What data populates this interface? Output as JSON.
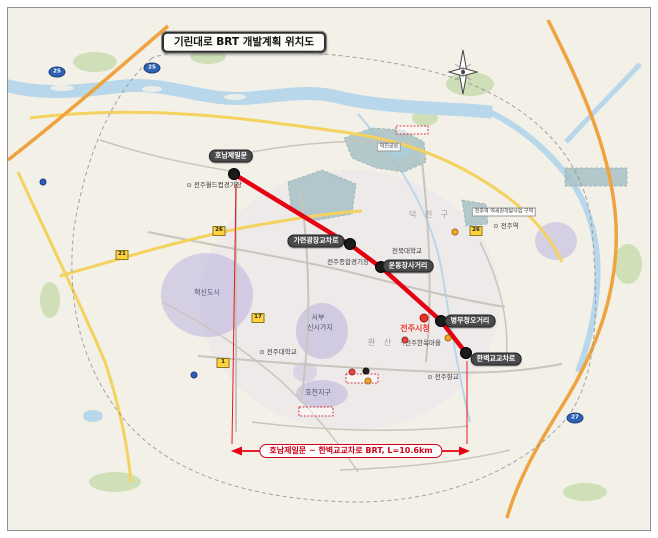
{
  "title": "기린대로 BRT 개발계획 위치도",
  "route": {
    "color": "#e60012",
    "summary_label": "호남제일문 ~ 한벽교교차로 BRT,  L=10.6km",
    "stops": [
      {
        "label": "호남제일문",
        "dot": {
          "x": 234,
          "y": 174
        },
        "pill": {
          "x": 231,
          "y": 156
        }
      },
      {
        "label": "가련광장교차로",
        "dot": {
          "x": 350,
          "y": 244
        },
        "pill": {
          "x": 316,
          "y": 241
        }
      },
      {
        "label": "운동장사거리",
        "dot": {
          "x": 381,
          "y": 267
        },
        "pill": {
          "x": 408,
          "y": 266
        }
      },
      {
        "label": "병무청오거리",
        "dot": {
          "x": 441,
          "y": 321
        },
        "pill": {
          "x": 470,
          "y": 321
        }
      },
      {
        "label": "한벽교교차로",
        "dot": {
          "x": 466,
          "y": 353
        },
        "pill": {
          "x": 496,
          "y": 359
        }
      }
    ]
  },
  "city_hall": {
    "label": "전주시청",
    "x": 415,
    "y": 329,
    "dot": {
      "x": 424,
      "y": 318
    }
  },
  "districts": [
    {
      "label": "덕 진 구",
      "x": 430,
      "y": 215
    },
    {
      "label": "완 산 구",
      "x": 389,
      "y": 343
    }
  ],
  "landmarks": [
    {
      "label": "전주월드컵경기장",
      "x": 214,
      "y": 185,
      "style": "tiny",
      "icon": true
    },
    {
      "label": "덕진공원",
      "x": 389,
      "y": 147,
      "style": "boxed",
      "icon": false
    },
    {
      "label": "전주역 역세권개발사업 구역",
      "x": 504,
      "y": 212,
      "style": "boxed",
      "icon": false
    },
    {
      "label": "전주역",
      "x": 506,
      "y": 226,
      "style": "tiny",
      "icon": true
    },
    {
      "label": "전북대학교",
      "x": 407,
      "y": 251,
      "style": "tiny",
      "icon": false
    },
    {
      "label": "전주종합경기장",
      "x": 348,
      "y": 262,
      "style": "tiny",
      "icon": false
    },
    {
      "label": "혁신도시",
      "x": 207,
      "y": 293,
      "style": "zone",
      "icon": false
    },
    {
      "label": "서부",
      "x": 318,
      "y": 318,
      "style": "zone",
      "icon": false
    },
    {
      "label": "신시가지",
      "x": 320,
      "y": 328,
      "style": "zone",
      "icon": false
    },
    {
      "label": "전주대학교",
      "x": 278,
      "y": 352,
      "style": "tiny",
      "icon": true
    },
    {
      "label": "효천지구",
      "x": 318,
      "y": 393,
      "style": "zone",
      "icon": false
    },
    {
      "label": "전주한옥마을",
      "x": 423,
      "y": 343,
      "style": "tiny",
      "icon": false
    },
    {
      "label": "전주향교",
      "x": 443,
      "y": 377,
      "style": "tiny",
      "icon": true
    }
  ],
  "road_shields": [
    {
      "x": 57,
      "y": 72,
      "kind": "expressway",
      "num": "25"
    },
    {
      "x": 152,
      "y": 68,
      "kind": "expressway",
      "num": "25"
    },
    {
      "x": 575,
      "y": 418,
      "kind": "expressway",
      "num": "27"
    },
    {
      "x": 122,
      "y": 255,
      "kind": "national",
      "num": "21"
    },
    {
      "x": 219,
      "y": 231,
      "kind": "national",
      "num": "26"
    },
    {
      "x": 258,
      "y": 318,
      "kind": "national",
      "num": "17"
    },
    {
      "x": 223,
      "y": 363,
      "kind": "national",
      "num": "1"
    },
    {
      "x": 476,
      "y": 231,
      "kind": "national",
      "num": "26"
    }
  ],
  "poi_dots": [
    {
      "x": 352,
      "y": 372,
      "color": "#e8453c"
    },
    {
      "x": 368,
      "y": 381,
      "color": "#f5a623"
    },
    {
      "x": 366,
      "y": 371,
      "color": "#222222"
    },
    {
      "x": 405,
      "y": 340,
      "color": "#e8453c"
    },
    {
      "x": 448,
      "y": 338,
      "color": "#f5a623"
    },
    {
      "x": 455,
      "y": 232,
      "color": "#f5a623"
    },
    {
      "x": 43,
      "y": 182,
      "color": "#2b5fb8"
    },
    {
      "x": 194,
      "y": 375,
      "color": "#2b5fb8"
    }
  ],
  "colors": {
    "map_bg": "#f3f0e8",
    "river": "#b9d7ea",
    "route_red": "#e60012",
    "zone_purple": "#b6aedd",
    "zone_teal": "#a8c2c6"
  }
}
